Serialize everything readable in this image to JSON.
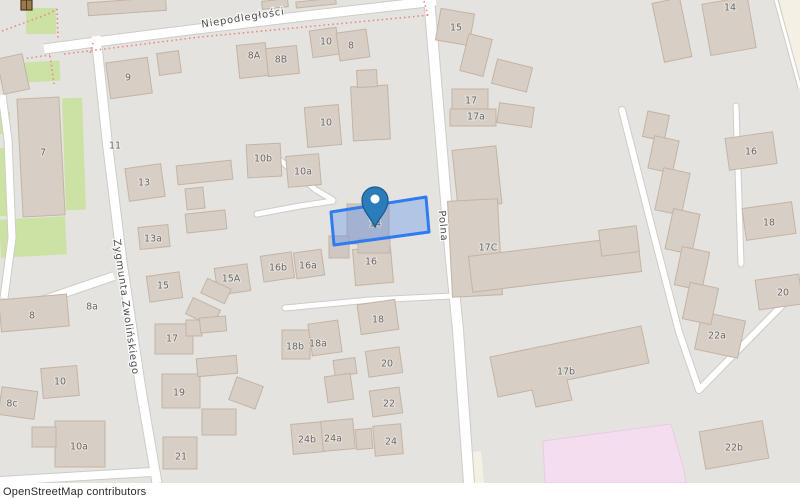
{
  "attribution": "OpenStreetMap contributors",
  "map": {
    "colors": {
      "bg": "#e5e3df",
      "building_fill": "#d7cec6",
      "building_stroke": "#c3b4a4",
      "selected_building_fill": "#cfc8c2",
      "green": "#cbe2a4",
      "pink": "#f5ddf0",
      "pink_stroke": "#e9cbe2",
      "cream": "#f4f1e4",
      "road": "#ffffff",
      "road_casing": "#cfccc7",
      "fence": "#ee8585",
      "label": "#6b6761",
      "street_label": "#4c4c4c",
      "selection_stroke": "#2e7cf0",
      "selection_fill": "rgba(64,128,244,0.30)",
      "marker_fill": "#2a7cba",
      "marker_stroke": "#185a8d",
      "monument_fill": "#9c7b4a",
      "monument_stroke": "#4a3a22"
    },
    "street_labels": [
      {
        "text": "Niepodległości",
        "x": 243,
        "y": 18,
        "rot": -9
      },
      {
        "text": "Polna",
        "x": 443,
        "y": 226,
        "rot": 85
      },
      {
        "text": "Zygmunta Zwolińskiego",
        "x": 126,
        "y": 307,
        "rot": 82
      }
    ],
    "address_labels": [
      {
        "text": "9",
        "x": 128,
        "y": 78
      },
      {
        "text": "8A",
        "x": 254,
        "y": 56
      },
      {
        "text": "8B",
        "x": 281,
        "y": 60
      },
      {
        "text": "10",
        "x": 326,
        "y": 42
      },
      {
        "text": "8",
        "x": 351,
        "y": 46
      },
      {
        "text": "7",
        "x": 43,
        "y": 153
      },
      {
        "text": "11",
        "x": 115,
        "y": 146
      },
      {
        "text": "10",
        "x": 326,
        "y": 123
      },
      {
        "text": "10b",
        "x": 263,
        "y": 159
      },
      {
        "text": "10a",
        "x": 303,
        "y": 172
      },
      {
        "text": "13",
        "x": 144,
        "y": 183
      },
      {
        "text": "13a",
        "x": 153,
        "y": 239
      },
      {
        "text": "15",
        "x": 456,
        "y": 28
      },
      {
        "text": "17",
        "x": 471,
        "y": 101
      },
      {
        "text": "17a",
        "x": 476,
        "y": 117
      },
      {
        "text": "14",
        "x": 730,
        "y": 8
      },
      {
        "text": "16",
        "x": 751,
        "y": 152
      },
      {
        "text": "18",
        "x": 769,
        "y": 223
      },
      {
        "text": "20",
        "x": 783,
        "y": 293
      },
      {
        "text": "22a",
        "x": 717,
        "y": 336
      },
      {
        "text": "17C",
        "x": 488,
        "y": 248
      },
      {
        "text": "14",
        "x": 375,
        "y": 224
      },
      {
        "text": "16",
        "x": 371,
        "y": 262
      },
      {
        "text": "16a",
        "x": 308,
        "y": 266
      },
      {
        "text": "16b",
        "x": 278,
        "y": 268
      },
      {
        "text": "15A",
        "x": 231,
        "y": 279
      },
      {
        "text": "15",
        "x": 163,
        "y": 286
      },
      {
        "text": "8a",
        "x": 92,
        "y": 307
      },
      {
        "text": "8",
        "x": 32,
        "y": 316
      },
      {
        "text": "17",
        "x": 172,
        "y": 339
      },
      {
        "text": "18b",
        "x": 295,
        "y": 347
      },
      {
        "text": "18a",
        "x": 318,
        "y": 344
      },
      {
        "text": "18",
        "x": 378,
        "y": 320
      },
      {
        "text": "20",
        "x": 387,
        "y": 364
      },
      {
        "text": "22",
        "x": 389,
        "y": 404
      },
      {
        "text": "19",
        "x": 179,
        "y": 393
      },
      {
        "text": "10",
        "x": 60,
        "y": 382
      },
      {
        "text": "8c",
        "x": 12,
        "y": 404
      },
      {
        "text": "10a",
        "x": 79,
        "y": 447
      },
      {
        "text": "21",
        "x": 181,
        "y": 457
      },
      {
        "text": "24b",
        "x": 307,
        "y": 440
      },
      {
        "text": "24a",
        "x": 333,
        "y": 439
      },
      {
        "text": "24",
        "x": 391,
        "y": 442
      },
      {
        "text": "17b",
        "x": 566,
        "y": 372
      },
      {
        "text": "22b",
        "x": 734,
        "y": 448
      }
    ],
    "green_areas": [
      [
        26,
        8,
        30,
        26,
        0
      ],
      [
        8,
        62,
        52,
        20,
        -3
      ],
      [
        64,
        98,
        20,
        112,
        -2
      ],
      [
        0,
        112,
        10,
        22,
        0
      ],
      [
        0,
        148,
        12,
        68,
        0
      ],
      [
        0,
        218,
        66,
        38,
        -3
      ]
    ],
    "cream_areas": [
      {
        "points": "779,0 800,0 800,92"
      },
      {
        "points": "465,453 481,451 484,483 468,483"
      }
    ],
    "pink_areas": [
      {
        "points": "543,441 671,424 684,470 686,483 545,483"
      }
    ],
    "roads": [
      {
        "d": "M 44,49 C 160,33 320,14 436,1",
        "w": 9,
        "cap": 0
      },
      {
        "d": "M 429,-2 L 441,140 L 450,250 L 458,330 L 469,483",
        "w": 10,
        "cap": 0
      },
      {
        "d": "M 96,36 L 107,140 L 122,262 L 141,390 L 157,483",
        "w": 9,
        "cap": 0
      },
      {
        "d": "M 0,315 L 114,276",
        "w": 8,
        "cap": 0
      },
      {
        "d": "M 2,95 L 8,140 L 12,238 L 4,298",
        "w": 7,
        "cap": 0
      },
      {
        "d": "M 0,481 L 100,475 L 152,472",
        "w": 8,
        "cap": 0
      },
      {
        "d": "M 622,110 L 653,232 L 679,332 L 699,390 L 800,287",
        "w": 6,
        "cap": 1
      },
      {
        "d": "M 736,106 L 741,264",
        "w": 5,
        "cap": 1
      },
      {
        "d": "M 257,214 L 300,206 L 333,201",
        "w": 5,
        "cap": 1
      },
      {
        "d": "M 285,308 L 370,300 L 452,296",
        "w": 5,
        "cap": 1
      },
      {
        "d": "M 281,161 L 316,190 L 333,200",
        "w": 5,
        "cap": 1
      },
      {
        "d": "M 776,0 L 800,88",
        "w": 3,
        "cap": 0
      }
    ],
    "fences": [
      "M 2,31 L 48,14 L 57,9",
      "M 57,9 L 58,40",
      "M 64,54 L 200,37 L 430,15",
      "M 90,53 L 94,40",
      "M 424,1 L 428,16",
      "M 0,62 L 50,55",
      "M 50,56 L 54,84"
    ],
    "buildings": [
      [
        88,
        0,
        78,
        13,
        -4
      ],
      [
        262,
        0,
        26,
        8,
        -6
      ],
      [
        296,
        0,
        40,
        6,
        -6
      ],
      [
        0,
        56,
        26,
        36,
        -12
      ],
      [
        20,
        98,
        42,
        118,
        -3
      ],
      [
        108,
        60,
        42,
        36,
        -8
      ],
      [
        158,
        52,
        22,
        22,
        -8
      ],
      [
        238,
        44,
        29,
        33,
        -6
      ],
      [
        267,
        47,
        31,
        28,
        -6
      ],
      [
        311,
        29,
        27,
        27,
        -8
      ],
      [
        338,
        31,
        30,
        28,
        -8
      ],
      [
        306,
        106,
        34,
        40,
        -5
      ],
      [
        352,
        86,
        37,
        54,
        -3
      ],
      [
        357,
        70,
        20,
        17,
        -3
      ],
      [
        247,
        144,
        34,
        33,
        -3
      ],
      [
        287,
        155,
        33,
        31,
        -5
      ],
      [
        127,
        166,
        36,
        33,
        -8
      ],
      [
        177,
        163,
        55,
        19,
        -6
      ],
      [
        186,
        188,
        18,
        21,
        -6
      ],
      [
        186,
        212,
        40,
        19,
        -6
      ],
      [
        139,
        226,
        30,
        22,
        -6
      ],
      [
        148,
        274,
        33,
        26,
        -8
      ],
      [
        216,
        266,
        33,
        27,
        -8
      ],
      [
        262,
        254,
        31,
        26,
        -8
      ],
      [
        295,
        251,
        28,
        26,
        -8
      ],
      [
        203,
        283,
        26,
        16,
        25
      ],
      [
        188,
        303,
        30,
        18,
        25
      ],
      [
        155,
        324,
        38,
        30,
        0
      ],
      [
        186,
        320,
        16,
        16,
        0
      ],
      [
        200,
        317,
        26,
        15,
        -5
      ],
      [
        162,
        374,
        38,
        34,
        0
      ],
      [
        197,
        357,
        40,
        18,
        -5
      ],
      [
        202,
        409,
        34,
        26,
        0
      ],
      [
        232,
        381,
        28,
        24,
        20
      ],
      [
        163,
        437,
        34,
        32,
        0
      ],
      [
        292,
        423,
        32,
        30,
        -5
      ],
      [
        322,
        420,
        32,
        30,
        -5
      ],
      [
        356,
        429,
        16,
        20,
        -5
      ],
      [
        374,
        425,
        28,
        30,
        -5
      ],
      [
        282,
        330,
        28,
        29,
        0
      ],
      [
        310,
        322,
        30,
        32,
        -8
      ],
      [
        359,
        302,
        38,
        30,
        -8
      ],
      [
        367,
        349,
        34,
        26,
        -8
      ],
      [
        334,
        359,
        22,
        16,
        -8
      ],
      [
        326,
        375,
        26,
        26,
        -8
      ],
      [
        371,
        389,
        30,
        26,
        -8
      ],
      [
        0,
        297,
        68,
        32,
        -5
      ],
      [
        0,
        389,
        36,
        28,
        8
      ],
      [
        42,
        367,
        36,
        30,
        -5
      ],
      [
        55,
        421,
        50,
        46,
        0
      ],
      [
        32,
        427,
        24,
        20,
        0
      ],
      [
        354,
        248,
        38,
        36,
        -5
      ],
      [
        438,
        11,
        34,
        32,
        10
      ],
      [
        464,
        36,
        24,
        38,
        14
      ],
      [
        494,
        63,
        36,
        25,
        14
      ],
      [
        452,
        89,
        36,
        22,
        0
      ],
      [
        450,
        109,
        46,
        17,
        0
      ],
      [
        498,
        105,
        35,
        20,
        8
      ],
      [
        455,
        148,
        44,
        58,
        -6
      ],
      [
        450,
        200,
        50,
        96,
        -3
      ],
      [
        470,
        246,
        170,
        36,
        -7
      ],
      [
        600,
        228,
        38,
        26,
        -7
      ],
      [
        706,
        0,
        46,
        52,
        -10
      ],
      [
        658,
        0,
        28,
        60,
        -12
      ],
      [
        727,
        135,
        48,
        32,
        -8
      ],
      [
        744,
        205,
        50,
        32,
        -8
      ],
      [
        757,
        277,
        44,
        30,
        -8
      ],
      [
        698,
        316,
        44,
        38,
        12
      ],
      [
        645,
        113,
        22,
        26,
        12
      ],
      [
        651,
        138,
        25,
        33,
        12
      ],
      [
        659,
        170,
        27,
        43,
        12
      ],
      [
        669,
        211,
        27,
        41,
        12
      ],
      [
        678,
        249,
        28,
        39,
        12
      ],
      [
        686,
        285,
        29,
        37,
        12
      ],
      [
        702,
        426,
        64,
        38,
        -10
      ]
    ],
    "selected_buildings": [
      [
        347,
        204,
        42,
        40,
        0
      ],
      [
        329,
        236,
        20,
        22,
        0
      ],
      [
        358,
        239,
        32,
        14,
        0
      ]
    ],
    "building_polys": [
      {
        "points": "490,357 641,326 649,363 567,380 572,400 536,407 532,390 498,397"
      }
    ],
    "selection": {
      "points": "331,212 426,197 429,232 334,245"
    },
    "marker": {
      "x": 375,
      "tip_y": 227
    },
    "monument_icon": {
      "x": 21,
      "y": 0,
      "w": 11,
      "h": 10
    }
  }
}
